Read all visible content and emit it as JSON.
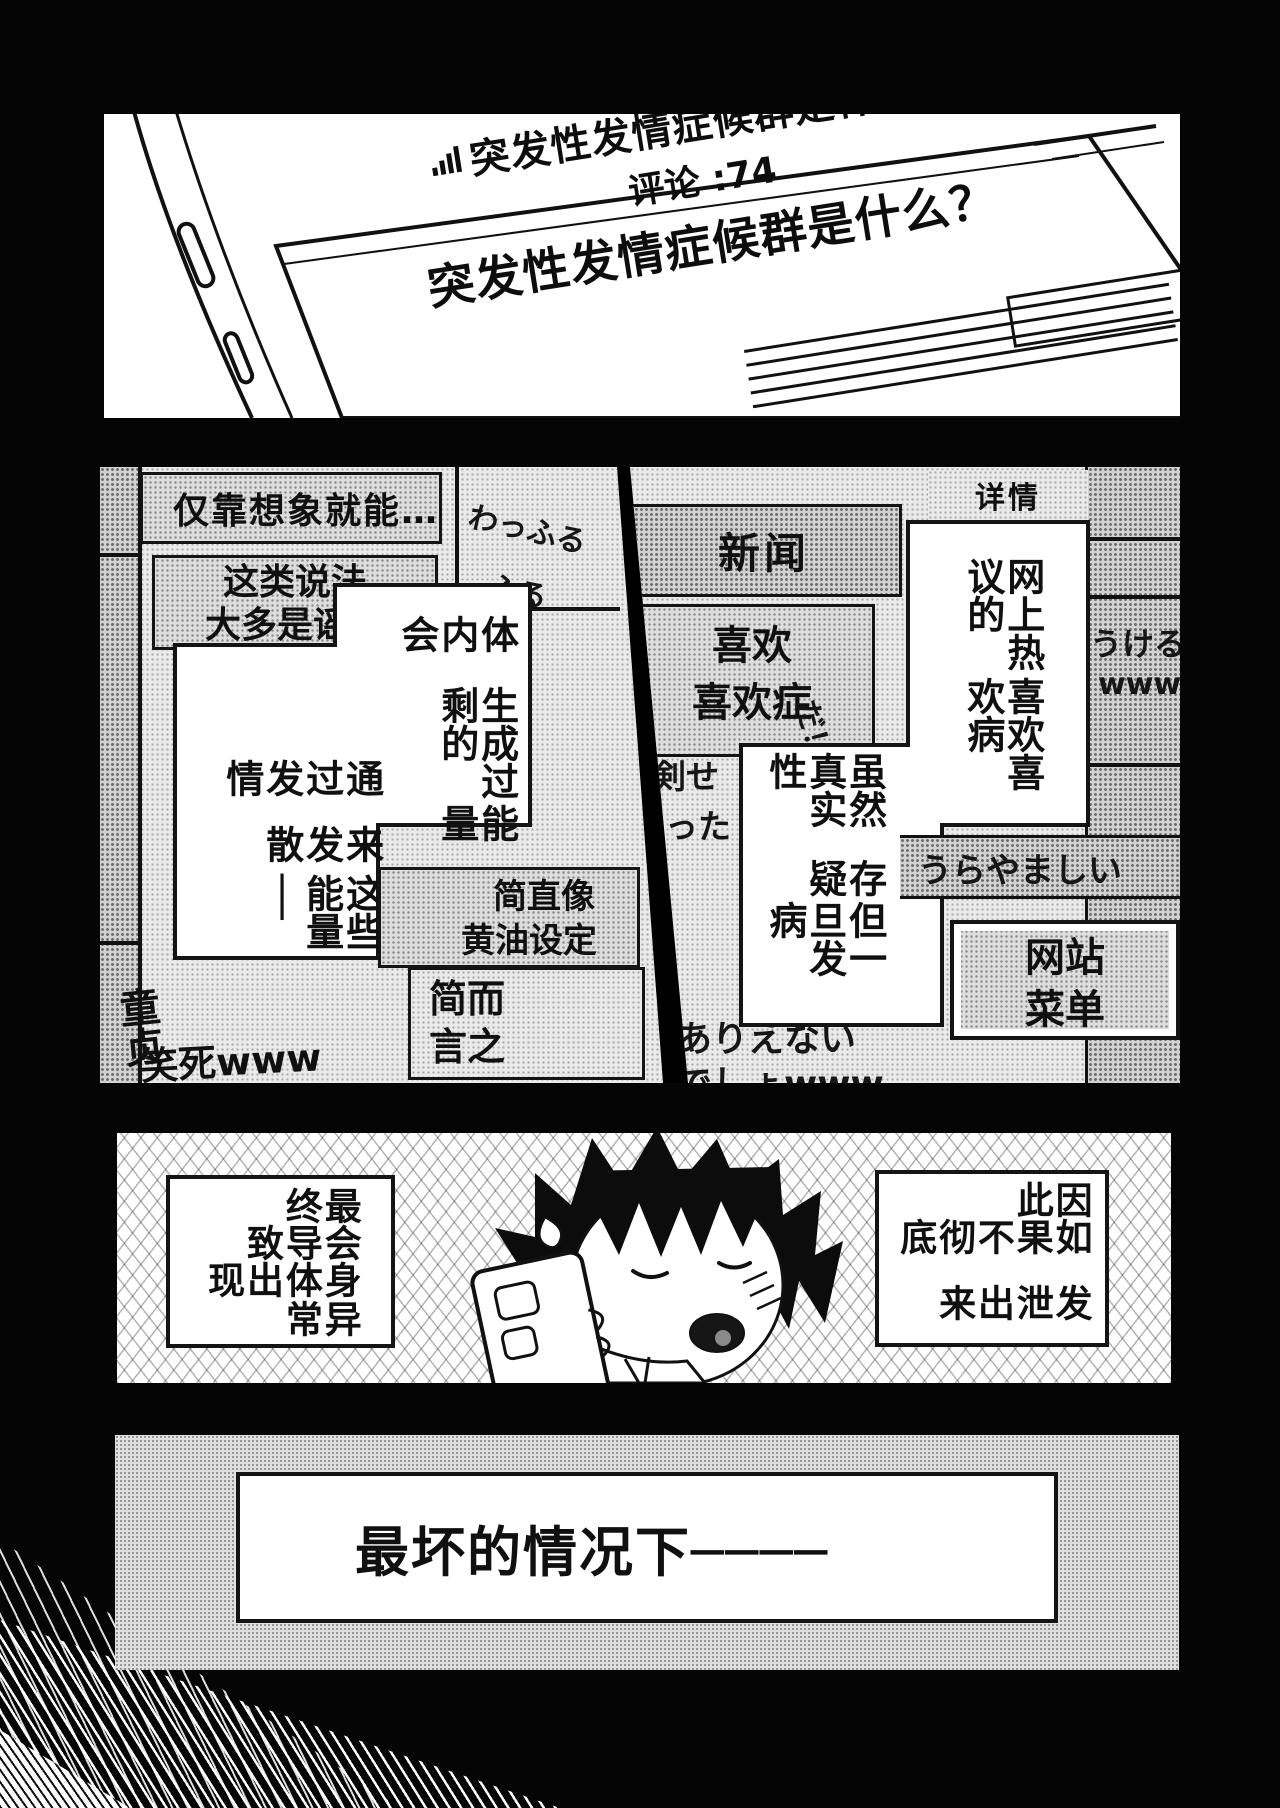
{
  "colors": {
    "ink": "#111111",
    "paper": "#ffffff",
    "page_bg": "#000000"
  },
  "phone": {
    "signal_icon": "signal-bars-icon",
    "line1": "突发性发情症候群是什么？",
    "line2": "评论 :74",
    "line3": "突发性发情症候群是什么？"
  },
  "mid_left": {
    "comment_imagine": "仅靠想象就能…",
    "bg_waffuru1": "わっふる",
    "bg_waffuru2": "ふる",
    "comment_rumor": [
      "这类说法",
      "大多是谣言"
    ],
    "bubble_energy": [
      "体内会",
      "生成过剩的",
      "能量"
    ],
    "bubble_release": [
      "通过发情",
      "来发散",
      "这些能量──"
    ],
    "comment_galge": [
      "简直像",
      "黄油设定"
    ],
    "comment_brief": [
      "简而",
      "言之"
    ],
    "bg_virgin": "童贞",
    "comment_lol": "笑死www"
  },
  "mid_right": {
    "header_news": "新闻",
    "header_details": "详情",
    "comment_like": [
      "喜欢",
      "喜欢症"
    ],
    "bg_da": "だ！",
    "bubble_net": [
      "网上热议的",
      "喜欢喜欢病"
    ],
    "bubble_doubt": [
      "虽然真实性",
      "存疑",
      "但一旦发病"
    ],
    "bg_ukeru": "うける",
    "bg_www": "www",
    "bg_shinken": "真剣せ",
    "bg_yatta": "やった",
    "bg_urayamashii": "うらやましい",
    "menu_box": [
      "网站",
      "菜单"
    ],
    "bg_arienai": "ありえない",
    "bg_deshou": "でしょwww"
  },
  "boy": {
    "caption_left": [
      "最终",
      "会导致",
      "身体出现",
      "异常"
    ],
    "caption_right": [
      "因此",
      "如果不彻底",
      "发泄出来"
    ]
  },
  "bottom": {
    "text": "最坏的情况下────"
  }
}
